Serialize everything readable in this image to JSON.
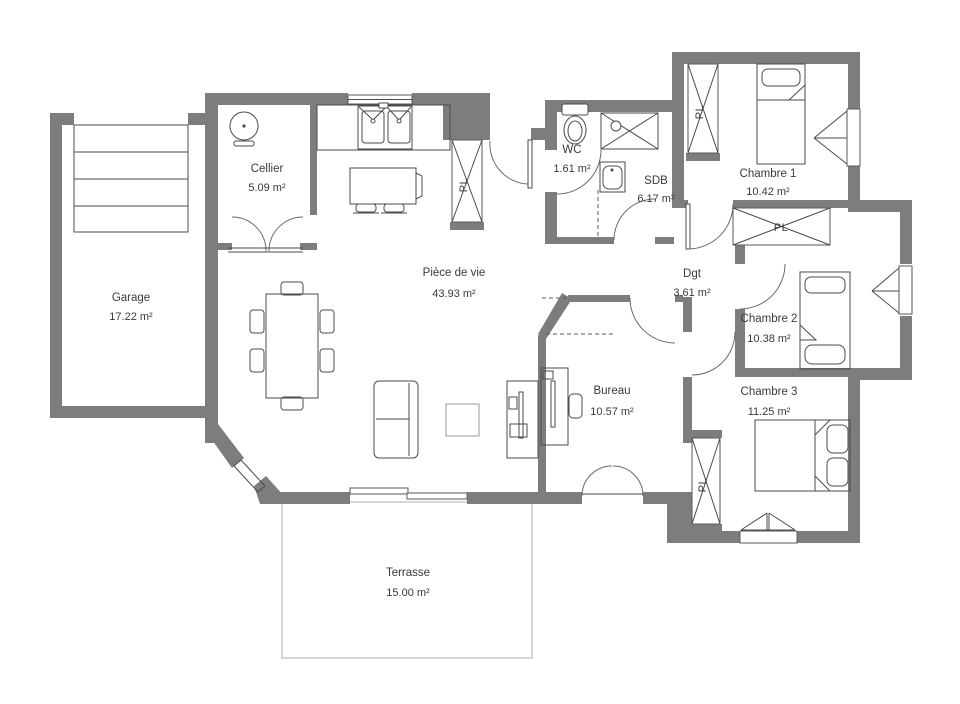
{
  "plan": {
    "rooms": {
      "garage": {
        "name": "Garage",
        "area": "17.22 m²"
      },
      "cellier": {
        "name": "Cellier",
        "area": "5.09 m²"
      },
      "piece_de_vie": {
        "name": "Pièce de vie",
        "area": "43.93 m²"
      },
      "wc": {
        "name": "WC",
        "area": "1.61 m²"
      },
      "sdb": {
        "name": "SDB",
        "area": "6.17 m²"
      },
      "chambre1": {
        "name": "Chambre 1",
        "area": "10.42 m²"
      },
      "dgt": {
        "name": "Dgt",
        "area": "3.61 m²"
      },
      "chambre2": {
        "name": "Chambre 2",
        "area": "10.38 m²"
      },
      "chambre3": {
        "name": "Chambre 3",
        "area": "11.25 m²"
      },
      "bureau": {
        "name": "Bureau",
        "area": "10.57 m²"
      },
      "terrasse": {
        "name": "Terrasse",
        "area": "15.00 m²"
      }
    },
    "closet_label": "PL",
    "colors": {
      "wall": "#7d7d7d",
      "line": "#4b4b4b",
      "text": "#3a3a3a",
      "terrace_border": "#c8c8c8"
    }
  }
}
